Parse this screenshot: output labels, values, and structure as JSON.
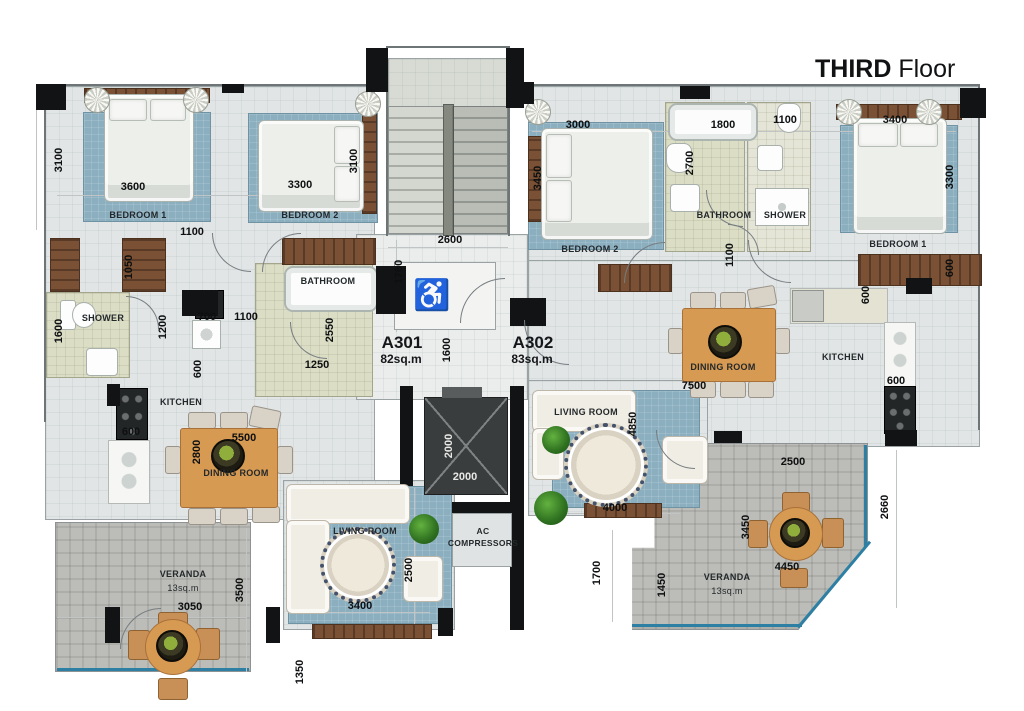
{
  "title": {
    "bold": "THIRD",
    "regular": " Floor"
  },
  "units": {
    "a301": {
      "id": "A301",
      "area": "82sq.m"
    },
    "a302": {
      "id": "A302",
      "area": "83sq.m"
    }
  },
  "rooms": {
    "l_bedroom1": "BEDROOM 1",
    "l_bedroom2": "BEDROOM 2",
    "l_bathroom": "BATHROOM",
    "l_shower": "SHOWER",
    "l_kitchen": "KITCHEN",
    "l_dining": "DINING ROOM",
    "l_living": "LIVING ROOM",
    "l_veranda": "VERANDA",
    "l_veranda_area": "13sq.m",
    "r_bedroom1": "BEDROOM 1",
    "r_bedroom2": "BEDROOM 2",
    "r_bathroom": "BATHROOM",
    "r_shower": "SHOWER",
    "r_kitchen": "KITCHEN",
    "r_dining": "DINING ROOM",
    "r_living": "LIVING ROOM",
    "r_veranda": "VERANDA",
    "r_veranda_area": "13sq.m",
    "ac1": "AC",
    "ac2": "COMPRESSORS"
  },
  "dims": {
    "l_bd1_h": "3100",
    "l_bd1_w": "3600",
    "l_bd2_w": "3300",
    "l_bd2_h": "3100",
    "l_hall": "1100",
    "l_closet": "1050",
    "l_shower_h": "1600",
    "l_1200": "1200",
    "l_700": "700",
    "l_1100b": "1100",
    "l_600wc": "600",
    "l_600stove": "600",
    "l_bath_h": "2550",
    "l_bath_w": "1250",
    "l_dining_w": "5500",
    "l_dining_h": "2800",
    "l_living_w": "3400",
    "l_living_h": "2500",
    "l_ver_w": "3050",
    "l_ver_h": "3500",
    "l_edge": "1350",
    "c_stairs_w": "2600",
    "c_stairs_h": "1760",
    "c_entry": "1600",
    "c_lift_h": "2000",
    "c_lift_w": "2000",
    "c_edge": "1700",
    "r_bd2_w": "3000",
    "r_bd2_h": "3450",
    "r_bath_w": "1800",
    "r_bath_h": "2700",
    "r_shower_w": "1100",
    "r_bd1_w": "3400",
    "r_bd1_h": "3300",
    "r_bd1_ward": "600",
    "r_hall": "1100",
    "r_dining_w": "7500",
    "r_living_h": "4850",
    "r_living_w": "4000",
    "r_kitchen_600a": "600",
    "r_kitchen_600b": "600",
    "r_ver_top": "2500",
    "r_ver_h": "3450",
    "r_ver_w": "4450",
    "r_ver_left": "1450",
    "r_edge": "2660"
  },
  "icons": {
    "accessible": "♿"
  },
  "palette": {
    "rug_blue": "#8cafc0",
    "floor_gray": "#e2e5e6",
    "tile_khaki": "#dbddc5",
    "veranda_gray": "#bcbdb8",
    "wood_dark": "#7a5134",
    "wood_table": "#d79a52",
    "wall_black": "#111314",
    "window_teal": "#2d7fa4"
  }
}
